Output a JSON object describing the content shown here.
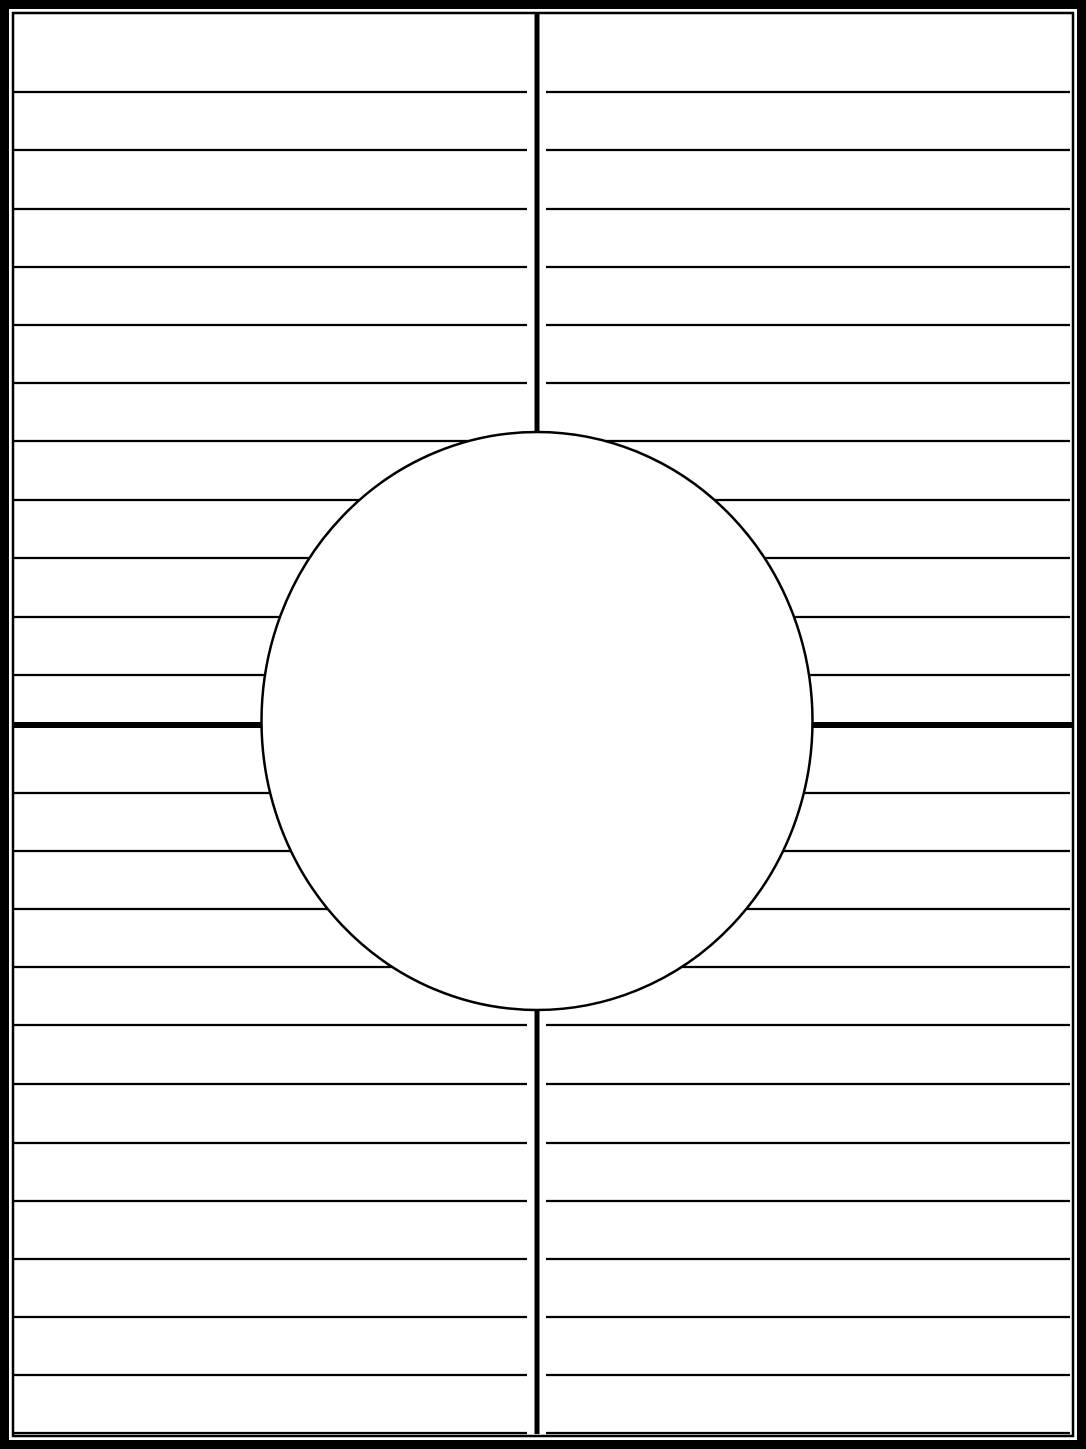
{
  "document": {
    "kind": "blank four-quadrant graphic organizer worksheet with center circle",
    "visible_text": "",
    "page": {
      "width": 1086,
      "height": 1449,
      "background": "#ffffff"
    },
    "frame": {
      "color": "#000000",
      "outer_thickness": 9,
      "inner_inset": 13,
      "inner_thickness": 2.5
    },
    "dividers": {
      "vertical": {
        "x": 537,
        "y1": 13,
        "y2": 1434,
        "thickness": 5,
        "color": "#000000"
      },
      "horizontal": {
        "y": 725,
        "x1": 14,
        "x2": 1072,
        "thickness": 6,
        "color": "#000000"
      }
    },
    "ruled_lines": {
      "color": "#000000",
      "thickness": 2.2,
      "x_start": 14,
      "x_end": 1070,
      "center_gap_from": 527,
      "center_gap_to": 546,
      "top_section_y": [
        92,
        150,
        209,
        267,
        325,
        383,
        441,
        500,
        558,
        617,
        675
      ],
      "bottom_section_y": [
        793,
        851,
        909,
        967,
        1025,
        1084,
        1143,
        1201,
        1259,
        1317,
        1375,
        1433
      ],
      "top_line_count": 11,
      "bottom_line_count": 12
    },
    "center_circle": {
      "cx": 537,
      "cy": 721,
      "rx": 275.5,
      "ry": 289,
      "stroke": "#000000",
      "stroke_width": 2.5,
      "fill": "#ffffff"
    }
  }
}
